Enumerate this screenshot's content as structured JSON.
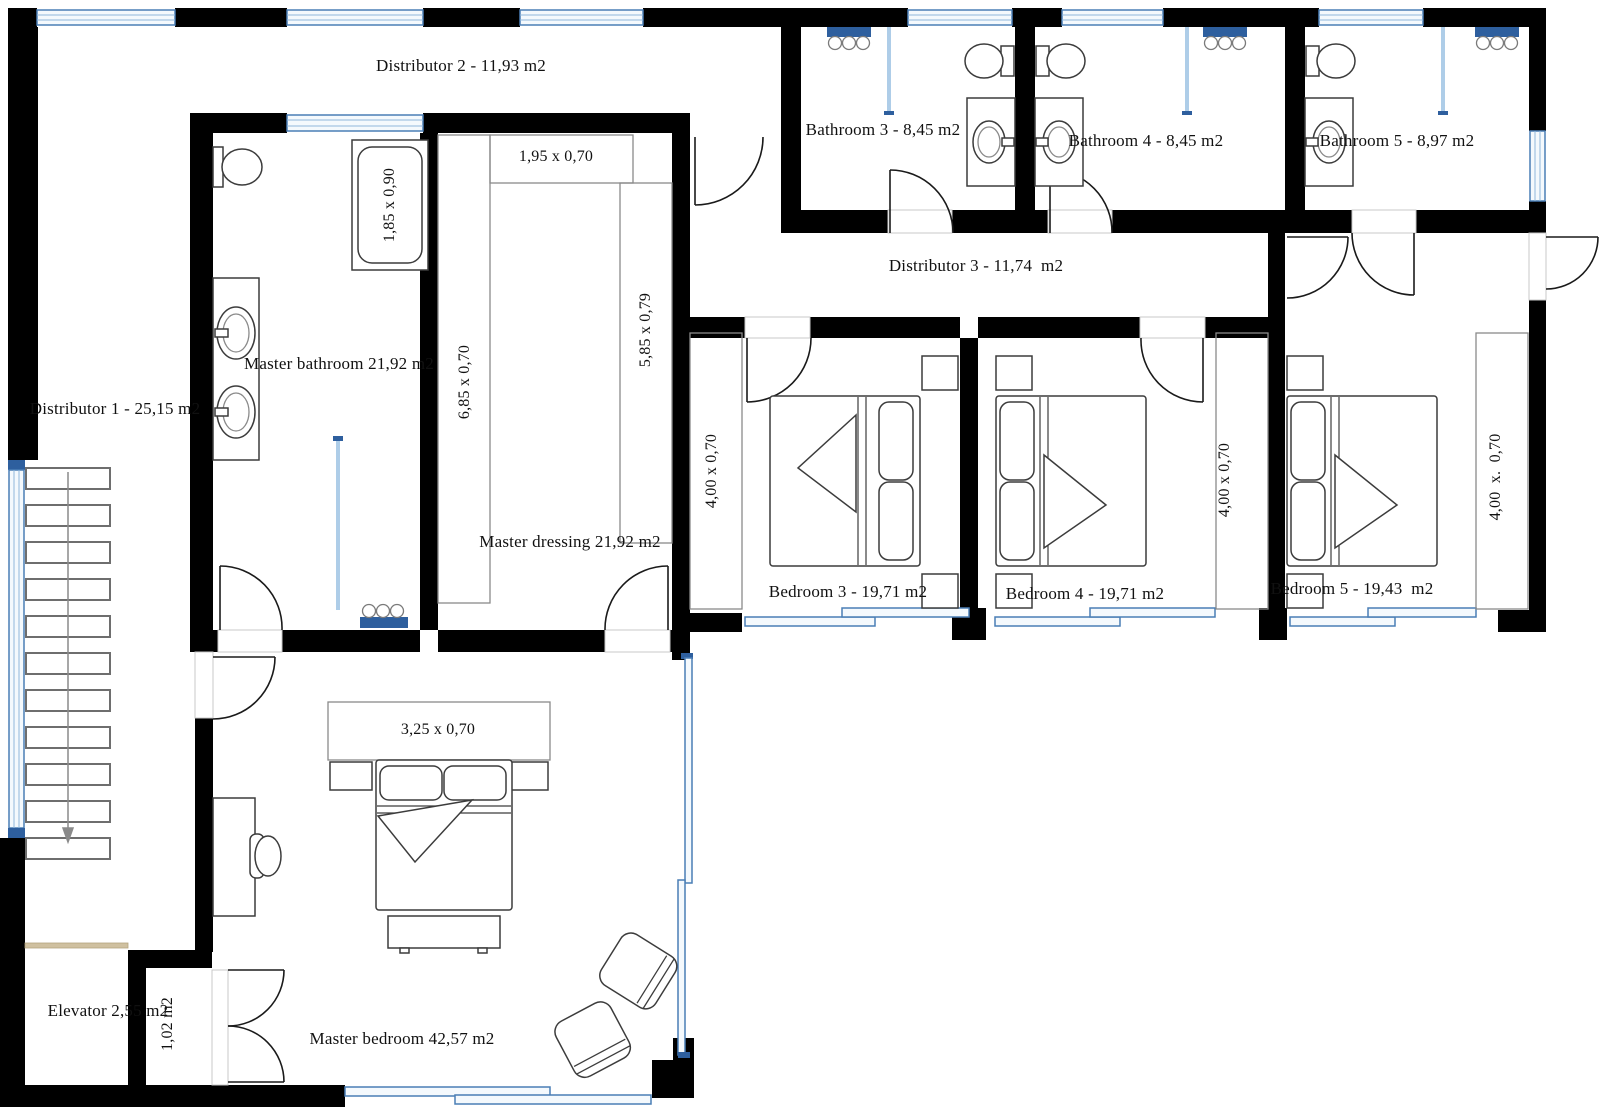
{
  "plan": {
    "type": "architectural-floor-plan",
    "colors": {
      "wall": "#000000",
      "window_frame_blue": "#4a7eb5",
      "window_cap_blue": "#2e5f9e",
      "shower_glass_blue": "#aecde8",
      "elevator_door_beige": "#cfc0a0"
    },
    "rooms": [
      {
        "name": "Distributor 1",
        "area": "25,15 m2"
      },
      {
        "name": "Distributor 2",
        "area": "11,93 m2"
      },
      {
        "name": "Distributor 3",
        "area": "11,74 m2"
      },
      {
        "name": "Master bathroom",
        "area": "21,92 m2"
      },
      {
        "name": "Master dressing",
        "area": "21,92 m2"
      },
      {
        "name": "Master bedroom",
        "area": "42,57 m2"
      },
      {
        "name": "Bathroom 3",
        "area": "8,45 m2"
      },
      {
        "name": "Bathroom 4",
        "area": "8,45 m2"
      },
      {
        "name": "Bathroom 5",
        "area": "8,97 m2"
      },
      {
        "name": "Bedroom 3",
        "area": "19,71 m2"
      },
      {
        "name": "Bedroom 4",
        "area": "19,71 m2"
      },
      {
        "name": "Bedroom 5",
        "area": "19,43 m2"
      },
      {
        "name": "Elevator",
        "area": "2,55 m2"
      },
      {
        "name": "Closet",
        "area": "1,02 m2"
      }
    ]
  },
  "labels": {
    "distributor2": "Distributor 2 - 11,93 m2",
    "bathroom3": "Bathroom 3 - 8,45 m2",
    "bathroom4": "Bathroom 4 - 8,45 m2",
    "bathroom5": "Bathroom 5 - 8,97 m2",
    "distributor3": "Distributor 3 - 11,74  m2",
    "master_bathroom": "Master bathroom 21,92 m2",
    "distributor1": "Distributor 1 - 25,15 m2",
    "dressing_top_wardrobe": "1,95 x 0,70",
    "bathtub": "1,85 x 0,90",
    "dressing_left_wardrobe": "6,85 x 0,70",
    "dressing_right_wardrobe": "5,85 x 0,79",
    "master_dressing": "Master dressing 21,92 m2",
    "wardrobe_bedroom3": "4,00 x 0,70",
    "bedroom3": "Bedroom 3 - 19,71 m2",
    "bedroom4": "Bedroom 4 - 19,71 m2",
    "wardrobe_bedroom4": "4,00 x 0,70",
    "bedroom5": "Bedroom 5 - 19,43  m2",
    "wardrobe_bedroom5": "4,00  x.  0,70",
    "master_wardrobe": "3,25 x 0,70",
    "master_bedroom": "Master bedroom 42,57 m2",
    "elevator": "Elevator 2,55 m2",
    "closet102": "1,02 m2"
  }
}
